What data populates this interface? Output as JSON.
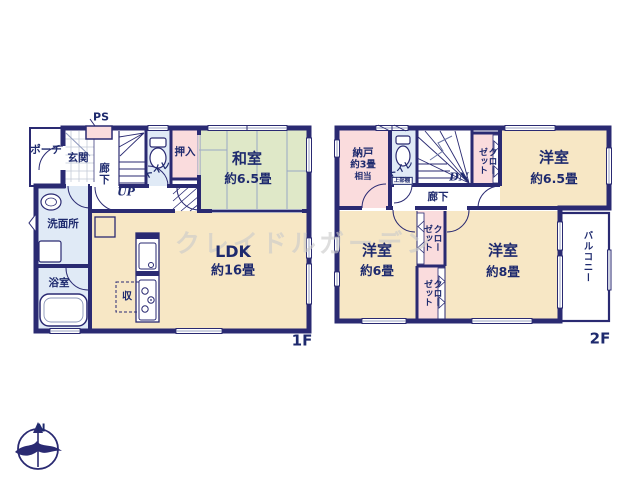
{
  "watermark": "クレイドルガーデン",
  "compass": {
    "north": "N"
  },
  "colors": {
    "wall": "#2a2a72",
    "label_text": "#1e2a6e",
    "tatami_green": "#dfe8c8",
    "room_cream": "#f7e7c5",
    "closet_pink": "#fadcdd",
    "water_blue": "#e0eaf6",
    "watermark_gray": "#cbcbcb"
  },
  "floor1": {
    "label": "1F",
    "porch": "ポーチ",
    "entrance": "玄関",
    "hallway": "廊下",
    "ps": "PS",
    "stairs_up": "UP",
    "toilet": "トイレ",
    "closet": "押入",
    "tatami_room": {
      "name": "和室",
      "size": "約6.5畳"
    },
    "washroom": "洗面所",
    "bathroom": "浴室",
    "ldk": {
      "name": "LDK",
      "size": "約16畳"
    },
    "storage": "収"
  },
  "floor2": {
    "label": "2F",
    "storeroom": {
      "name": "納戸",
      "size_line1": "約3畳",
      "size_line2": "相当"
    },
    "toilet": "トイレ",
    "toilet_shelf": "上部棚",
    "stairs_down": "DN",
    "hallway": "廊下",
    "closet": {
      "line1": "クロー",
      "line2": "ゼット"
    },
    "bedroom_65": {
      "name": "洋室",
      "size": "約6.5畳"
    },
    "bedroom_6": {
      "name": "洋室",
      "size": "約6畳"
    },
    "bedroom_8": {
      "name": "洋室",
      "size": "約8畳"
    },
    "balcony": "バルコニー"
  }
}
